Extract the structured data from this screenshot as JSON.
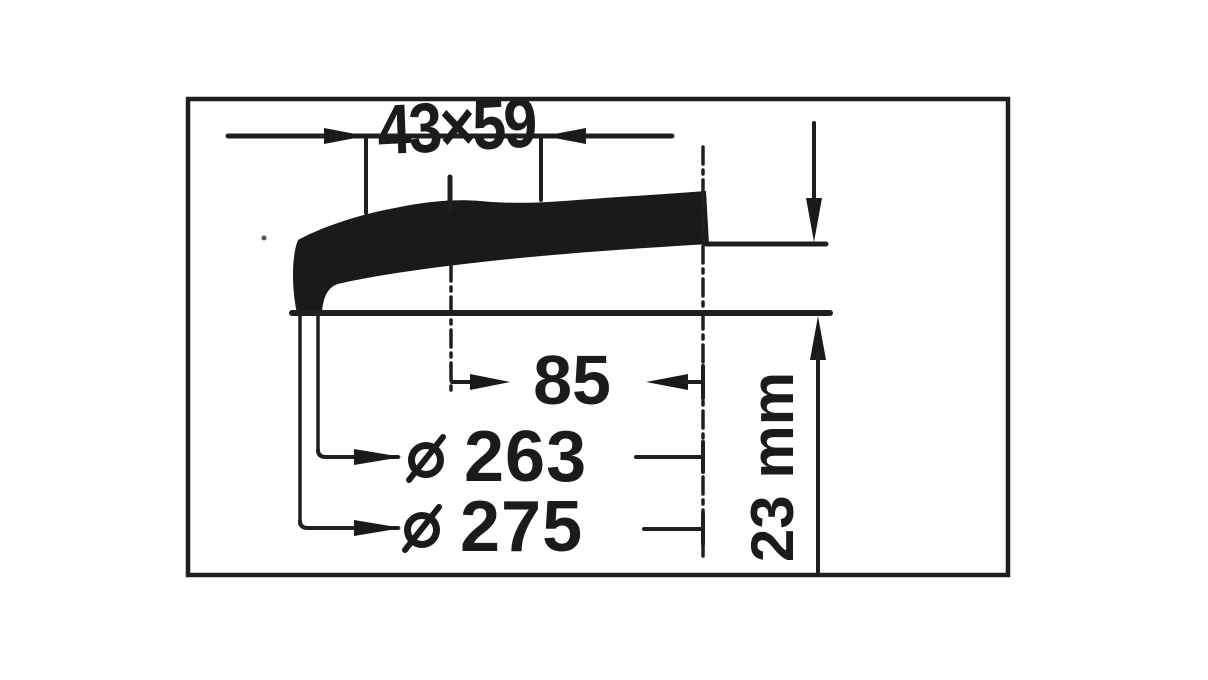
{
  "drawing": {
    "labels": {
      "top_width": "43×59",
      "depth": "85",
      "diameter_small": {
        "symbol": "⌀",
        "value": "263"
      },
      "diameter_large": {
        "symbol": "⌀",
        "value": "275"
      },
      "thickness": "23 mm"
    },
    "colors": {
      "ink": "#1c1c1c",
      "paper": "#ffffff"
    }
  }
}
